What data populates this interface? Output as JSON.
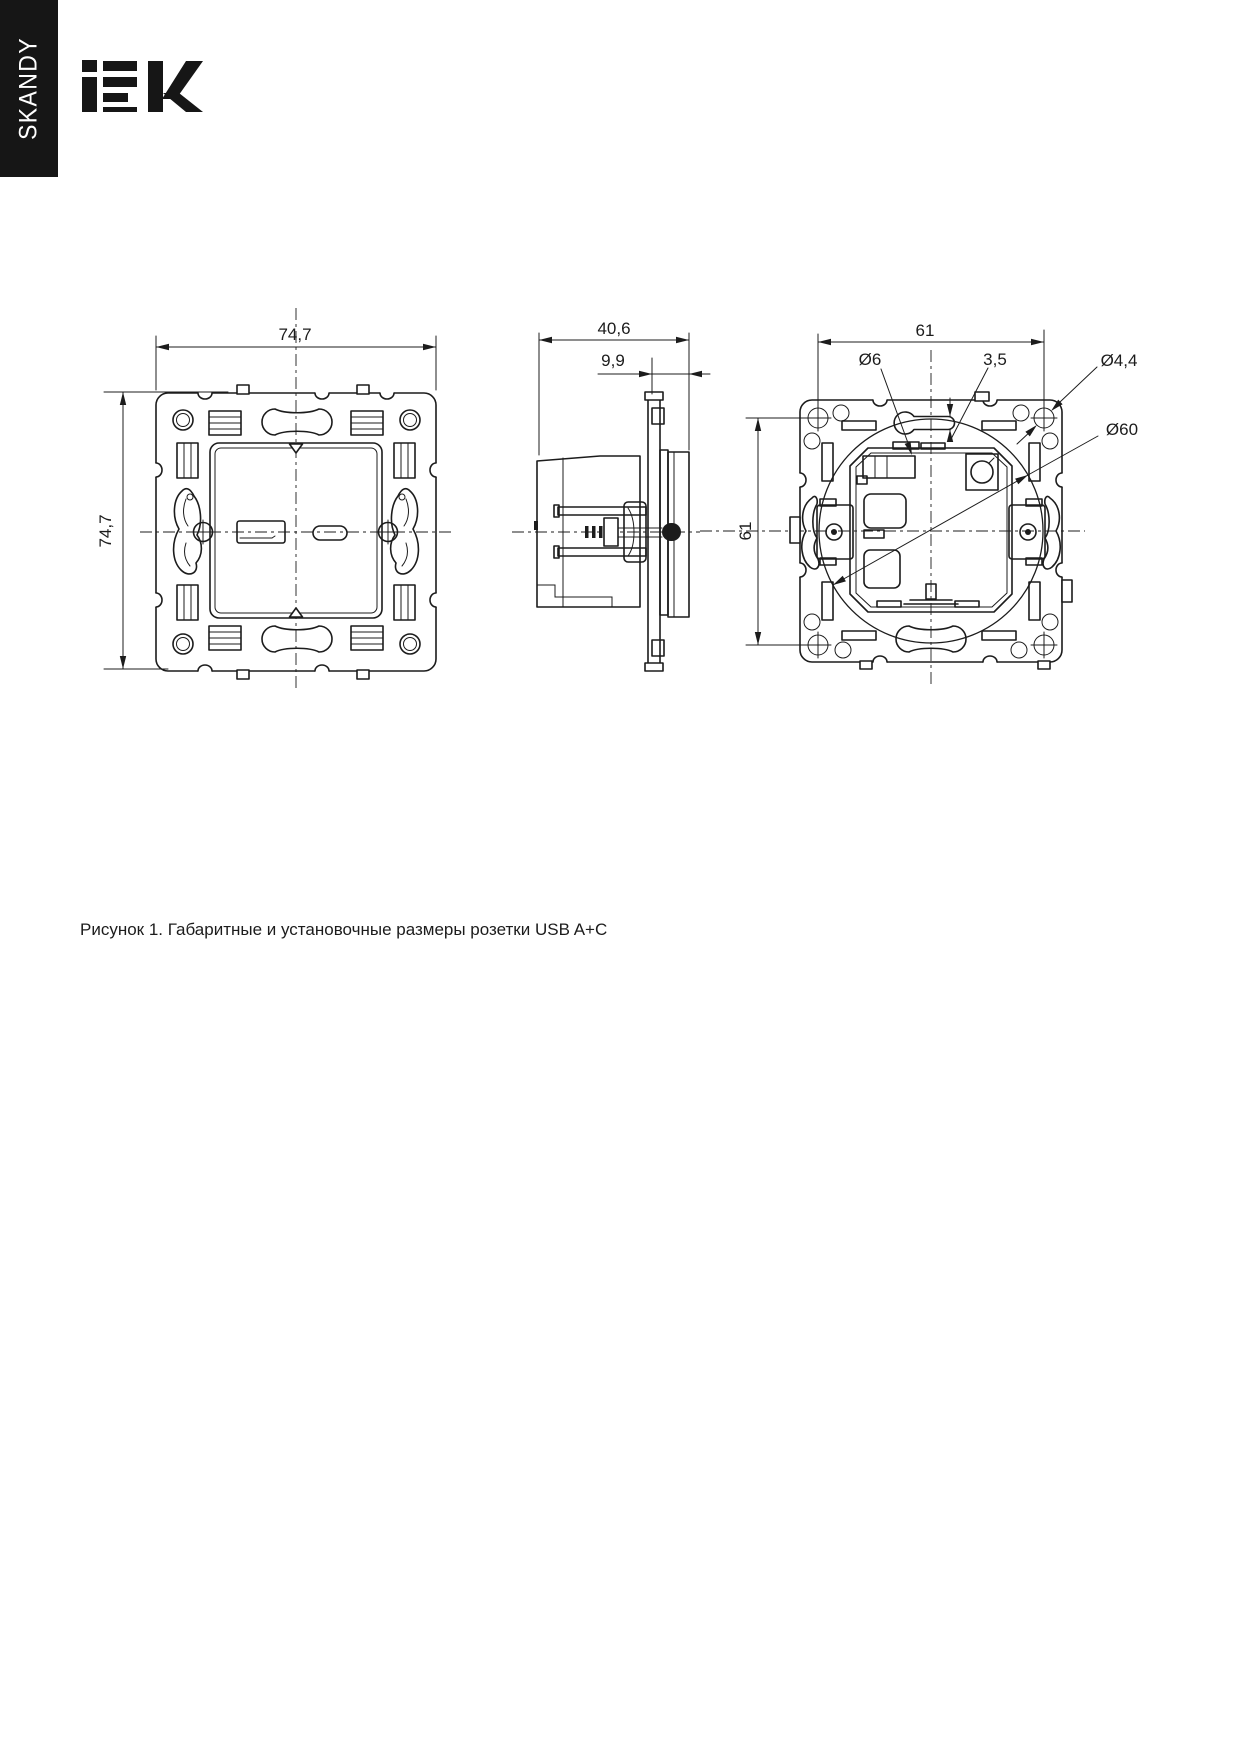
{
  "sidebar": {
    "label": "SKANDY"
  },
  "logo": {
    "brand": "iEK"
  },
  "figure": {
    "caption": "Рисунок 1. Габаритные и установочные размеры розетки USB A+C",
    "dims": {
      "front_width": "74,7",
      "front_height": "74,7",
      "side_depth": "40,6",
      "side_panel": "9,9",
      "back_width": "61",
      "back_height": "61",
      "hole_dia": "Ø6",
      "slot_width": "3,5",
      "screw_hole_dia": "Ø4,4",
      "support_dia": "Ø60"
    },
    "colors": {
      "line": "#1c1c1c",
      "background": "#ffffff",
      "sidebar_bg": "#161616",
      "sidebar_text": "#ffffff"
    }
  }
}
